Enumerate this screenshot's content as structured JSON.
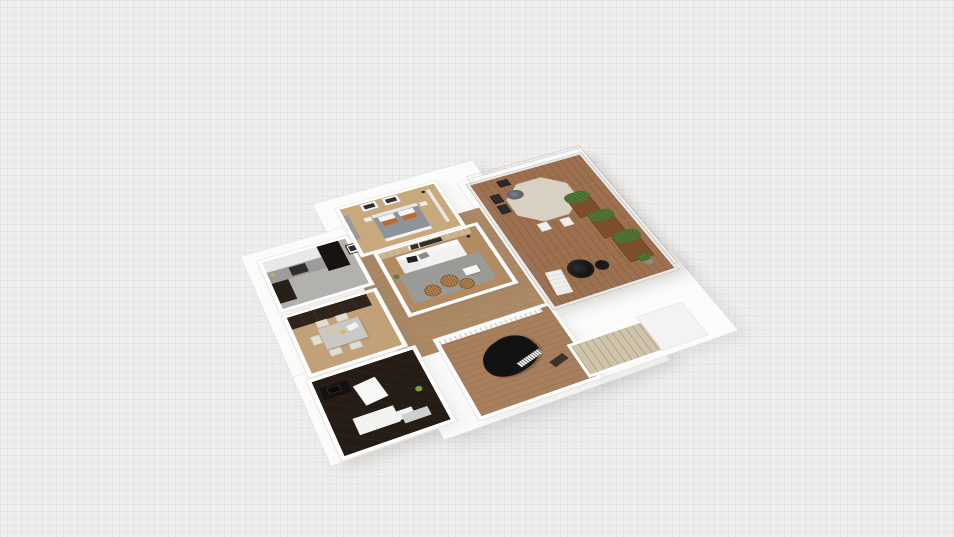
{
  "canvas": {
    "width": 954,
    "height": 537,
    "background": "#f0efee",
    "grid_line": "#bebcb8",
    "description": "3D perspective render of an apartment floor plan on a faint grid canvas"
  },
  "palette": {
    "platform": "#fbfbfa",
    "wall": "#ffffff",
    "wall_edge": "#dcdad7",
    "hallway_floor": "#ad8a66",
    "glass_rail": "#e9e8e6",
    "wireframe": "#878787"
  },
  "rooms": {
    "kitchen": {
      "name": "kitchen",
      "floor": "#b3b1ae",
      "upper_cabinets": "#e9e9e7",
      "tall_units": "#17130f",
      "counter": "#9c9c9c",
      "stove": "#2f2f2f",
      "lower_cabinets": "#262019",
      "accent_item": "#d8b830"
    },
    "bedroom": {
      "name": "bedroom",
      "floor": "#c8a87d",
      "accent_panel": "#9a9a98",
      "frame": "#f6f6f4",
      "frame_art": "#30302e",
      "blanket": "#8d9398",
      "headboard": "#e8e6e2",
      "pillow_white": "#f5f5f3",
      "pillow_orange": "#c4682a",
      "foot_throw": "#f2f1ef",
      "nightstand": "#efeeec",
      "lamp": "#1c1c1c",
      "curtain": "#ececea"
    },
    "living": {
      "name": "living-room",
      "floor": "#b28b63",
      "accent_wall": "#cdb492",
      "art": "#2f2f2d",
      "sofa": "#f3f2f0",
      "sofa_back": "#fbfbf9",
      "sofa_chaise": "#ecebe8",
      "pillow_black": "#1f1f1f",
      "pillow_gray": "#8b8b89",
      "rug": "#9a9a96",
      "pouf": "#b5854f",
      "coffee_table": "#f7f7f5",
      "lamp": "#1b1b1b",
      "plant": "#5d7d3a"
    },
    "dining": {
      "name": "dining-nook",
      "floor": "#c2a179",
      "cabinets": "#2e241c",
      "table": "#c8c8c5",
      "chair": "#e3ddd0",
      "cutting_board": "#d9c59c",
      "plate_yellow": "#d9b93a",
      "paper": "#f2f2f0"
    },
    "dark_room": {
      "name": "dark-floor-room",
      "floor": "#241c15",
      "partition": "#f7f7f6",
      "counter": "#f2f2f0",
      "desk": "#15100d",
      "monitor": "#0a0a0a",
      "plant": "#7aa23f",
      "slab": "#cfcfcd"
    },
    "piano_room": {
      "name": "piano-room",
      "floor": "#a87f5d",
      "railing": "#f8f8f6",
      "piano": "#121212",
      "piano_keys": "#f4f4f2",
      "bench": "#3a332b"
    },
    "balcony": {
      "name": "balcony-terrace",
      "deck": "#9c6f4e",
      "table": "#d8d1c3",
      "centerpiece": "#5c6164",
      "chair_dark": "#2b2b2b",
      "chair_white": "#efeeec",
      "planter_wood": "#7c4e29",
      "foliage": "#527736",
      "papasan_chair": "#111111",
      "side_table": "#1a1a1a",
      "lounger": "#efeeec",
      "pot": "#8a8a88"
    }
  },
  "hall_art": {
    "frame": "#f5f5f3",
    "art": "#2c2c2c"
  },
  "staircase": {
    "name": "staircase-down",
    "tread": "#cfc3ab",
    "landing": "#f4f3f1"
  }
}
